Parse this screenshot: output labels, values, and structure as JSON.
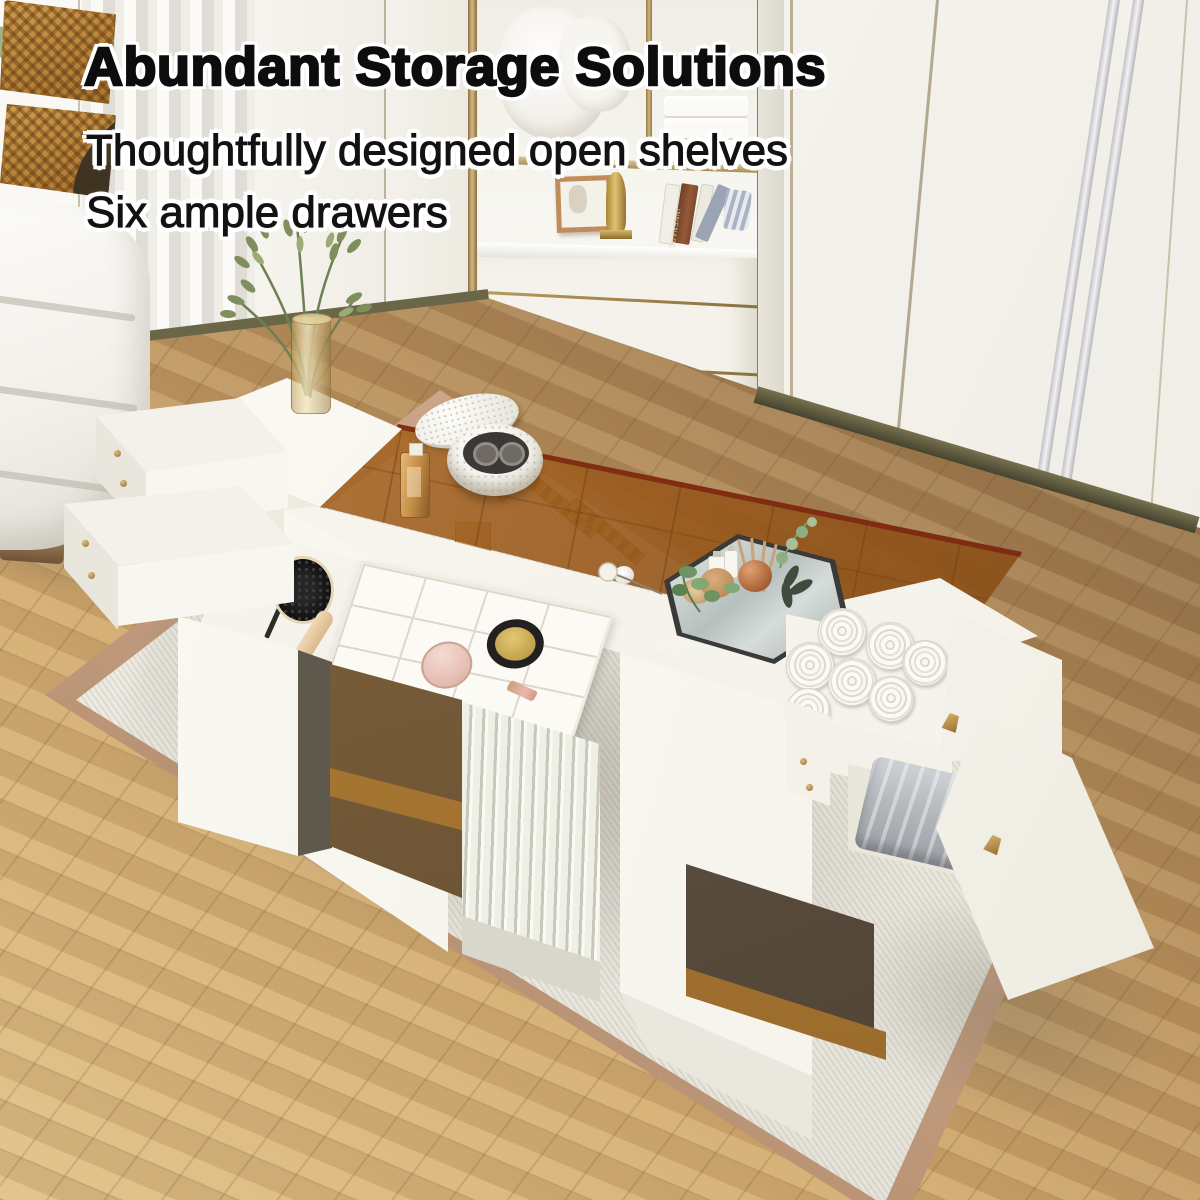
{
  "overlay": {
    "headline": "Abundant Storage Solutions",
    "subline1": "Thoughtfully designed open shelves",
    "subline2": "Six ample drawers"
  },
  "background": {
    "book_spine_text": "INNENARCH"
  },
  "palette": {
    "text_black": "#0d0d0d",
    "text_halo": "#ffffff",
    "furniture_white": "#f7f5ef",
    "amber_glass": "#b5772f",
    "gold_trim": "#a98c54",
    "wood_floor_light": "#d8b377",
    "wood_floor_dark": "#8d6c47",
    "rug_field": "#efede5",
    "rug_border": "#c19a7c",
    "baseboard_olive": "#55523a",
    "rattan_basket": "#c08a3e",
    "towel_grey": "#b7babf",
    "plant_green": "#7d9a6e",
    "mirror_tray_grey": "#c3cbc9"
  },
  "scene": {
    "room_elements": [
      "wardrobe-wall",
      "curtain",
      "built-in-shelf-niche",
      "herringbone-wood-floor",
      "area-rug",
      "white-ottoman"
    ],
    "niche_contents": [
      "white-pillows",
      "folded-towel-stack",
      "photo-frame",
      "gold-figurine",
      "books",
      "striped-cloth",
      "two-drawers"
    ],
    "table_elements": [
      "amber-glass-lid",
      "jewelry-compartments",
      "glass-vase-with-branches",
      "hexagonal-mirror-tray",
      "reed-diffuser",
      "perfume-bottle",
      "round-jewelry-box",
      "cosmetic-brush-tray",
      "organizer-grid-tray",
      "wrist-watch",
      "powder-compact",
      "lipstick",
      "rattan-baskets",
      "fluted-drawer-front",
      "open-cabinet-door",
      "rolled-towels-drawer",
      "folded-grey-towel-drawer",
      "pull-out-side-drawers",
      "gold-knobs"
    ]
  }
}
